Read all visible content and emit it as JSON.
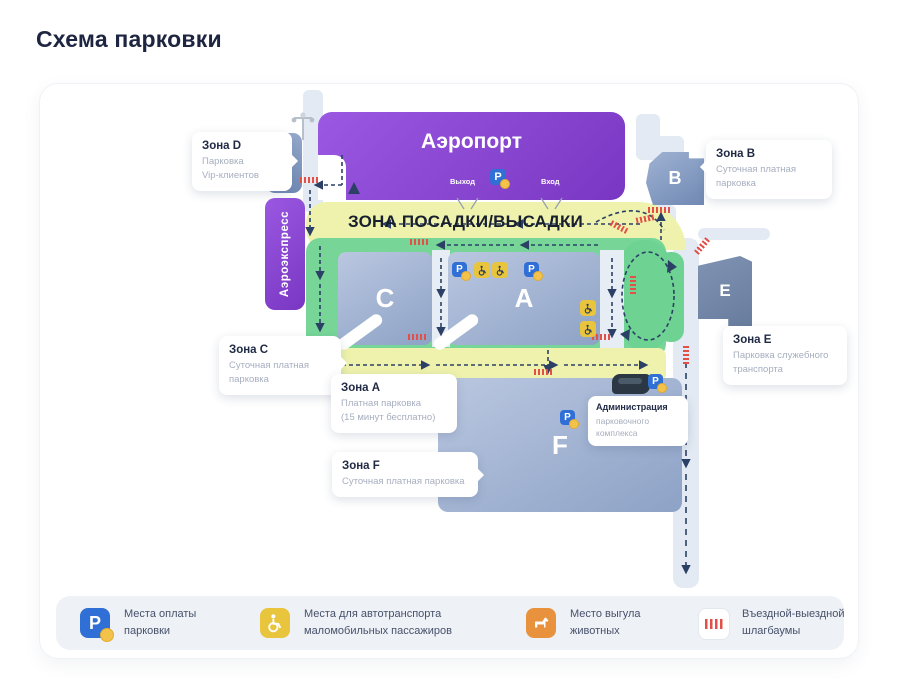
{
  "page": {
    "title": "Схема парковки"
  },
  "map": {
    "airport": {
      "label": "Аэропорт",
      "exit": "Выход",
      "entrance": "Вход"
    },
    "aeroexpress_label": "Аэроэкспресс",
    "dropoff_label": "ЗОНА ПОСАДКИ/ВЫСАДКИ",
    "buildings": {
      "d": "D",
      "b": "B",
      "e": "E"
    },
    "lots": {
      "c": "C",
      "a": "A",
      "f": "F"
    },
    "zones": {
      "d": {
        "title": "Зона D",
        "line1": "Парковка",
        "line2": "Vip-клиентов"
      },
      "b": {
        "title": "Зона B",
        "line1": "Суточная платная",
        "line2": "парковка"
      },
      "c": {
        "title": "Зона C",
        "line1": "Суточная платная",
        "line2": "парковка"
      },
      "a": {
        "title": "Зона A",
        "line1": "Платная парковка",
        "line2": "(15 минут бесплатно)"
      },
      "e": {
        "title": "Зона E",
        "line1": "Парковка служебного",
        "line2": "транспорта"
      },
      "f": {
        "title": "Зона F",
        "line1": "Суточная платная парковка"
      },
      "admin": {
        "title": "Администрация",
        "line1": "парковочного",
        "line2": "комплекса"
      }
    }
  },
  "legend": {
    "items": [
      {
        "icon": "parking-payment-icon",
        "line1": "Места оплаты",
        "line2": "парковки"
      },
      {
        "icon": "wheelchair-icon",
        "line1": "Места для автотранспорта",
        "line2": "маломобильных пассажиров"
      },
      {
        "icon": "dog-walking-icon",
        "line1": "Место выгула",
        "line2": "животных"
      },
      {
        "icon": "barrier-icon",
        "line1": "Въездной-выездной",
        "line2": "шлагбаумы"
      }
    ]
  },
  "icons": {
    "parking_letter": "P"
  },
  "colors": {
    "title_navy": "#1d2540",
    "airport_purple": "#8a4ad0",
    "map_green": "#77d697",
    "map_yellow": "#eef2ac",
    "parking_blue": "#2f6fd6",
    "disabled_yellow": "#e9c53d",
    "dog_orange": "#e8923d",
    "barrier_red": "#e25048",
    "lot_blue": "#8da2c6"
  }
}
